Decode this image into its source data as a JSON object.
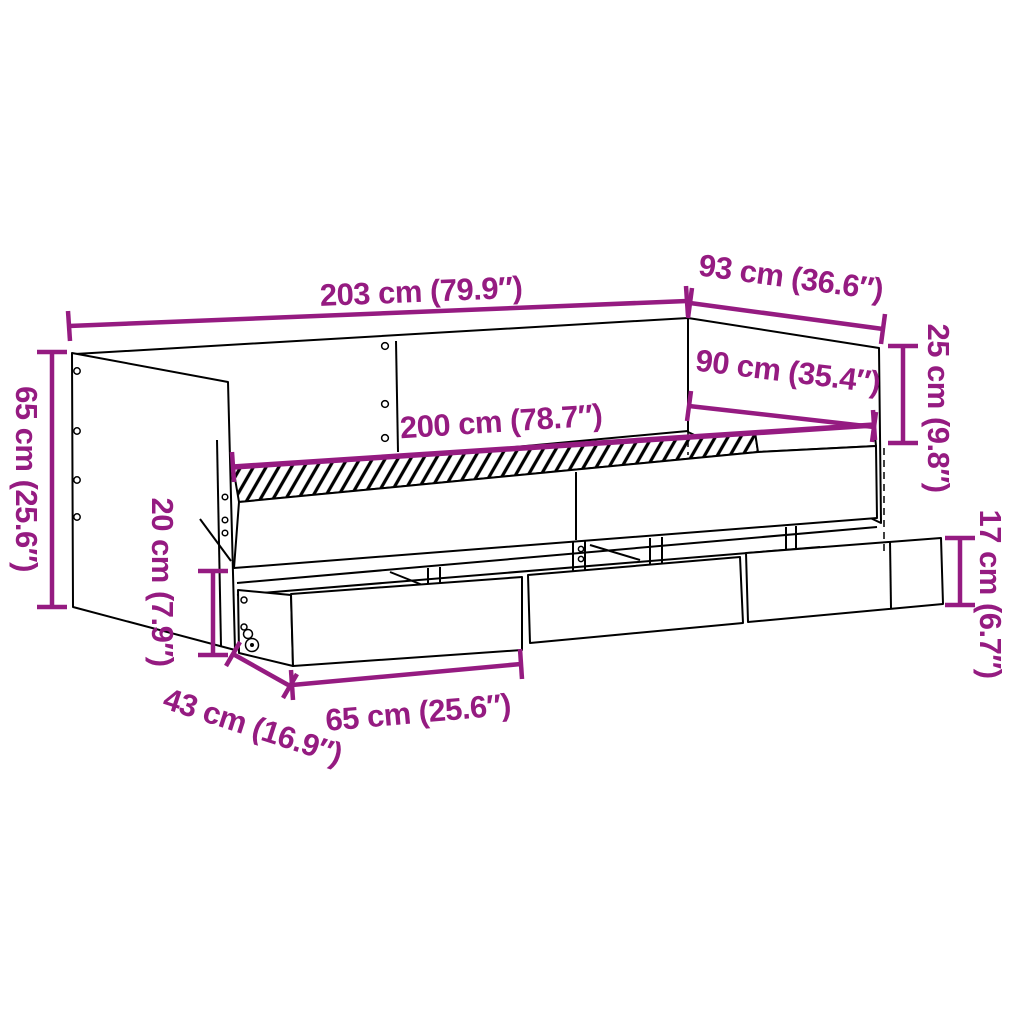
{
  "diagram": {
    "kind": "furniture-dimension-diagram",
    "subject": "daybed-with-3-drawers",
    "colors": {
      "dimension_accent": "#951b81",
      "outline": "#000000",
      "background": "#ffffff"
    },
    "dims": {
      "total_length": {
        "label": "203 cm (79.9″)"
      },
      "total_depth": {
        "label": "93 cm (36.6″)"
      },
      "backrest_height": {
        "label": "25 cm (9.8″)"
      },
      "sleep_width": {
        "label": "90 cm (35.4″)"
      },
      "sleep_length": {
        "label": "200 cm (78.7″)"
      },
      "side_height": {
        "label": "65 cm (25.6″)"
      },
      "under_clearance": {
        "label": "20 cm (7.9″)"
      },
      "drawer_height": {
        "label": "17 cm (6.7″)"
      },
      "drawer_pullout": {
        "label": "43 cm (16.9″)"
      },
      "drawer_width": {
        "label": "65 cm (25.6″)"
      }
    }
  }
}
